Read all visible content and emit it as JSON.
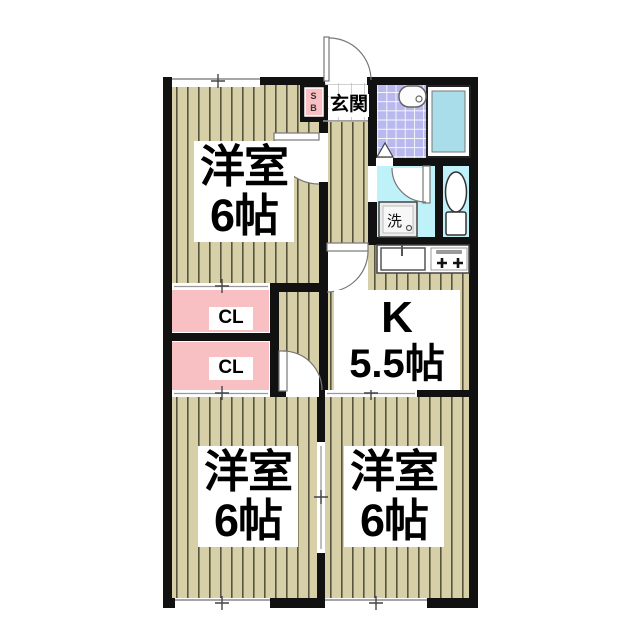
{
  "title": "apartment floor plan",
  "rooms": {
    "western_room_top": {
      "name": "洋室",
      "size": "6帖"
    },
    "western_room_bottom_left": {
      "name": "洋室",
      "size": "6帖"
    },
    "western_room_bottom_right": {
      "name": "洋室",
      "size": "6帖"
    },
    "kitchen": {
      "name": "K",
      "size": "5.5帖"
    },
    "entrance": {
      "label": "玄関"
    },
    "closet_upper": {
      "label": "CL"
    },
    "closet_lower": {
      "label": "CL"
    },
    "shoe_box": {
      "letter_top": "S",
      "letter_bottom": "B"
    },
    "laundry_machine": {
      "label": "洗"
    }
  },
  "colors": {
    "wall": "#111111",
    "flooring": "#d6cfa8",
    "flooring_stripe": "#56543c",
    "closet_pink": "#f9c0c4",
    "shoe_box_pink": "#f9bfc3",
    "bathroom_tile": "#b9b9ee",
    "water_room_cyan": "#bff1f8",
    "bathtub_cyan": "#a8dde9"
  }
}
